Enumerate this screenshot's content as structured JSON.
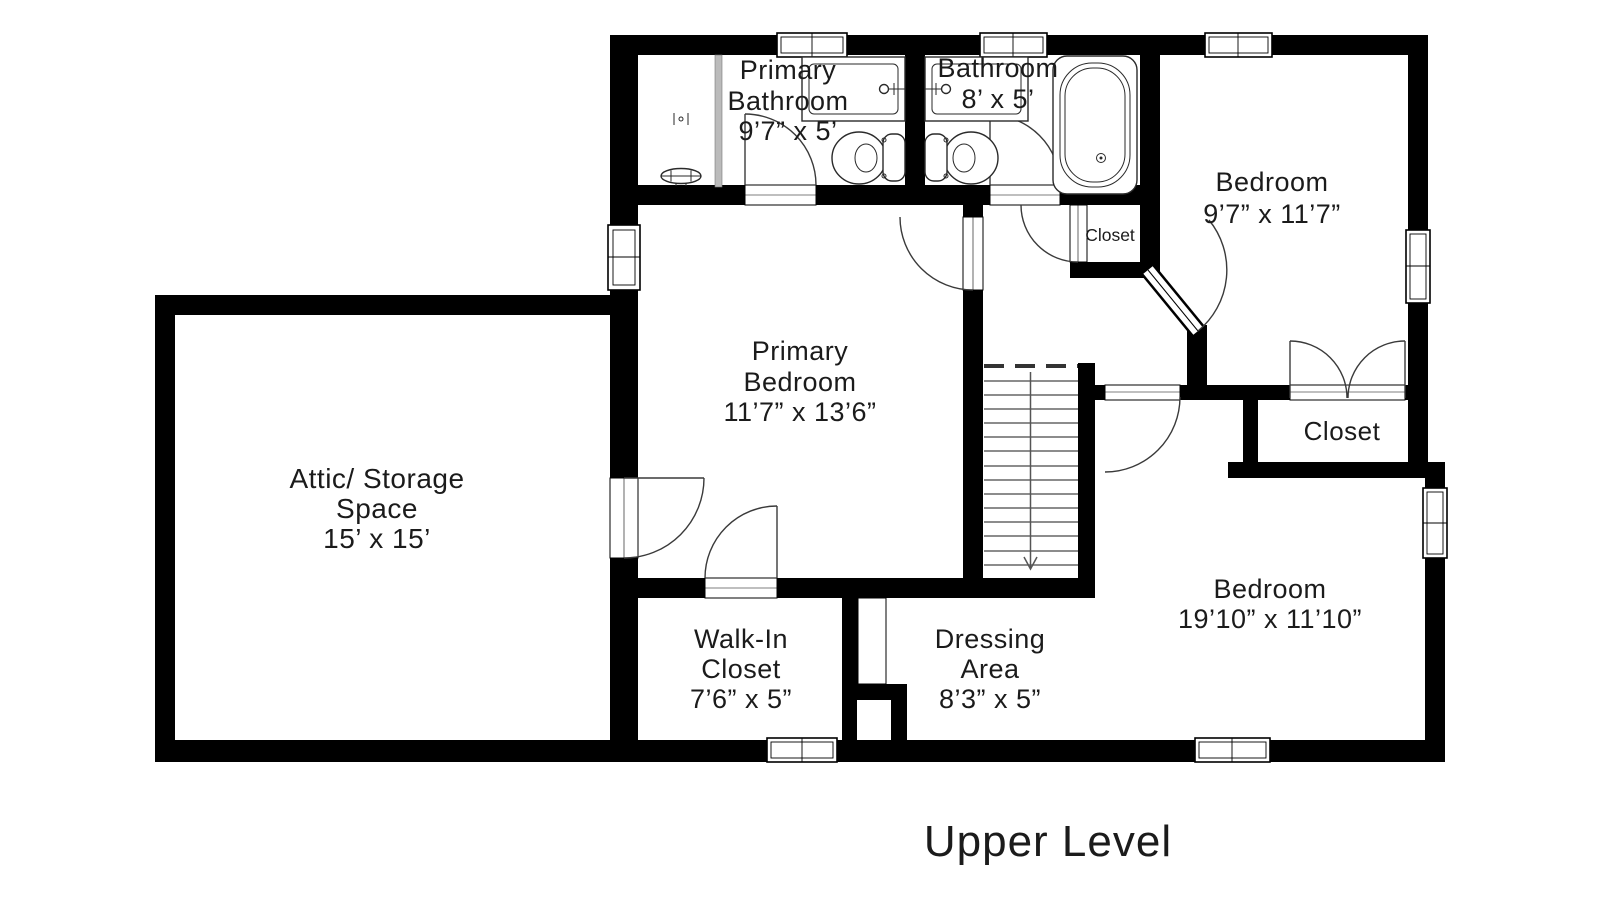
{
  "title": "Upper Level",
  "plan_colors": {
    "wall": "#000000",
    "background": "#ffffff",
    "glass": "#bbbbbb",
    "line": "#3a3a3a"
  },
  "rooms": {
    "attic": {
      "lines": [
        "Attic/ Storage",
        "Space",
        "15’ x 15’"
      ]
    },
    "primary_bathroom": {
      "lines": [
        "Primary",
        "Bathroom",
        "9’7” x 5’"
      ]
    },
    "bathroom": {
      "lines": [
        "Bathroom",
        "8’ x 5’"
      ]
    },
    "bedroom_top": {
      "lines": [
        "Bedroom",
        "9’7” x 11’7”"
      ]
    },
    "hall_closet": {
      "label": "Closet"
    },
    "primary_bedroom": {
      "lines": [
        "Primary",
        "Bedroom",
        "11’7” x 13’6”"
      ]
    },
    "closet_right": {
      "label": "Closet"
    },
    "walk_in_closet": {
      "lines": [
        "Walk-In",
        "Closet",
        "7’6” x 5”"
      ]
    },
    "dressing_area": {
      "lines": [
        "Dressing",
        "Area",
        "8’3” x 5”"
      ]
    },
    "bedroom_bottom": {
      "lines": [
        "Bedroom",
        "19’10” x 11’10”"
      ]
    }
  },
  "stairs": {
    "direction": "down"
  }
}
